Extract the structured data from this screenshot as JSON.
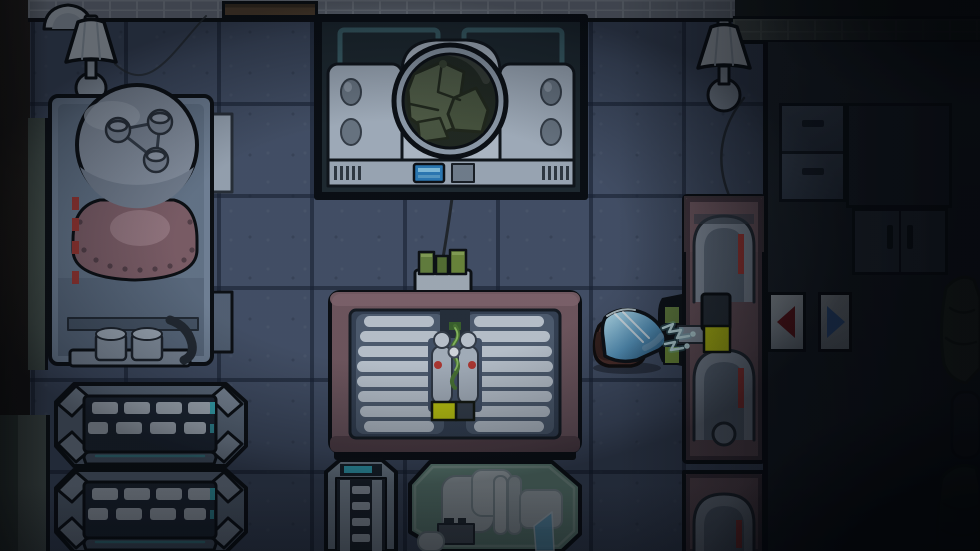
{
  "colors": {
    "floor": "#4a576f",
    "grout": "#39455b",
    "wall_brick": "#8d95a1",
    "machine_pink": "#7b5f66",
    "task_highlight": "#d7e00e",
    "arrow_red": "#8c1a1a",
    "arrow_blue": "#4d86d8",
    "spark_cyan": "#d9fcff",
    "visor_blue_light": "#c9f2fd",
    "visor_blue_dark": "#25587f",
    "capsule_red_stripe": "#c04038",
    "trash_green": "#57644a",
    "table_green": "#7ea795",
    "coil_white": "#cfd9e3",
    "lamp_shade": "#e3ecf4",
    "screen_blue": "#2f86c8",
    "connector_green": "#6e8c42",
    "crewmate_body": "#53302a"
  },
  "scene": {
    "setting": "top-down spaceship room, lights dimmed",
    "entities": {
      "lamps": {
        "count": 2,
        "desc": "white table lamps"
      },
      "boiler_machine": {
        "desc": "large tank machine with riveted pink barrel and pipes"
      },
      "scanner_machine": {
        "desc": "white machine with round porthole window",
        "porthole_contents": "green trash bags",
        "has_blue_screen": true
      },
      "coil_machine": {
        "desc": "engine console with two white coil banks and green DNA strand",
        "progress_bar_filled": true
      },
      "charge_column": {
        "capsules": 2,
        "has_task_highlight": true,
        "red_stripes": 2
      },
      "charge_column_lower": {
        "capsules": 1
      },
      "crewmate": {
        "pose": "lying down",
        "visor": "glossy blue dome",
        "sparking": true
      },
      "direction_panels": {
        "count": 2,
        "left": "red left arrow",
        "right": "blue right arrow"
      },
      "benches": {
        "count": 2,
        "slat_rows": 2,
        "slats_per_row": 4
      },
      "drawers": {
        "count": 2
      },
      "cabinet_doors": {
        "count": 2
      },
      "trash_bags_right": {
        "count": 2
      },
      "lab_table": {
        "desc": "green table with white instruments"
      },
      "equipment_rack": {
        "desc": "narrow rack with rungs and teal label"
      }
    }
  }
}
